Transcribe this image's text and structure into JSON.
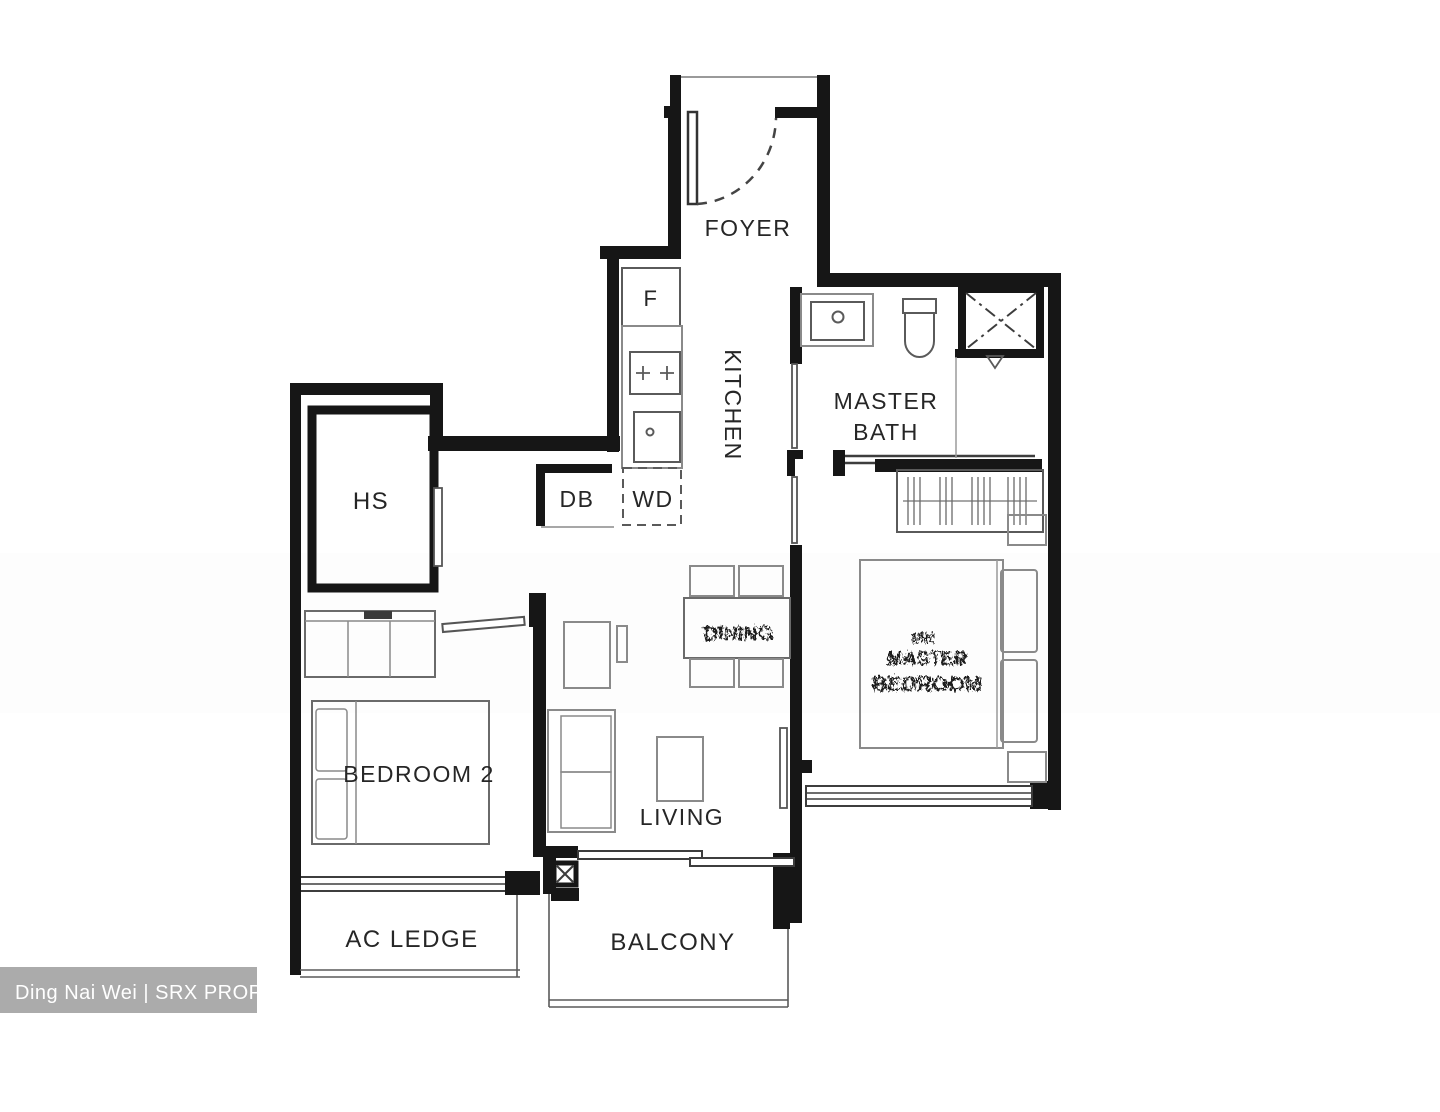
{
  "image": {
    "type": "residential floor plan",
    "width": 1440,
    "height": 1112
  },
  "labels": {
    "foyer": "FOYER",
    "kitchen": "KITCHEN",
    "fridge": "F",
    "wash_dry": "WD",
    "distribution_board": "DB",
    "household_shelter": "HS",
    "master_bath_line1": "MASTER",
    "master_bath_line2": "BATH",
    "bedroom2": "BEDROOM  2",
    "living": "LIVING",
    "dining_garbled": "DINING",
    "master_bedroom_garbled_line1": "MR",
    "master_bedroom_garbled_line2": "MASTER",
    "master_bedroom_garbled_line3": "BEDROOM",
    "ac_ledge": "AC  LEDGE",
    "balcony": "BALCONY"
  },
  "watermark": {
    "text": "Ding Nai Wei | SRX PROPERTY"
  },
  "colors": {
    "background": "#ffffff",
    "wall": "#161616",
    "window_line": "#3d3d3d",
    "fixture_line": "#5a5a5a",
    "furniture_line": "#8a8a8a",
    "label_text": "#262626",
    "watermark_bg": "#ababab",
    "watermark_text": "#ffffff"
  }
}
